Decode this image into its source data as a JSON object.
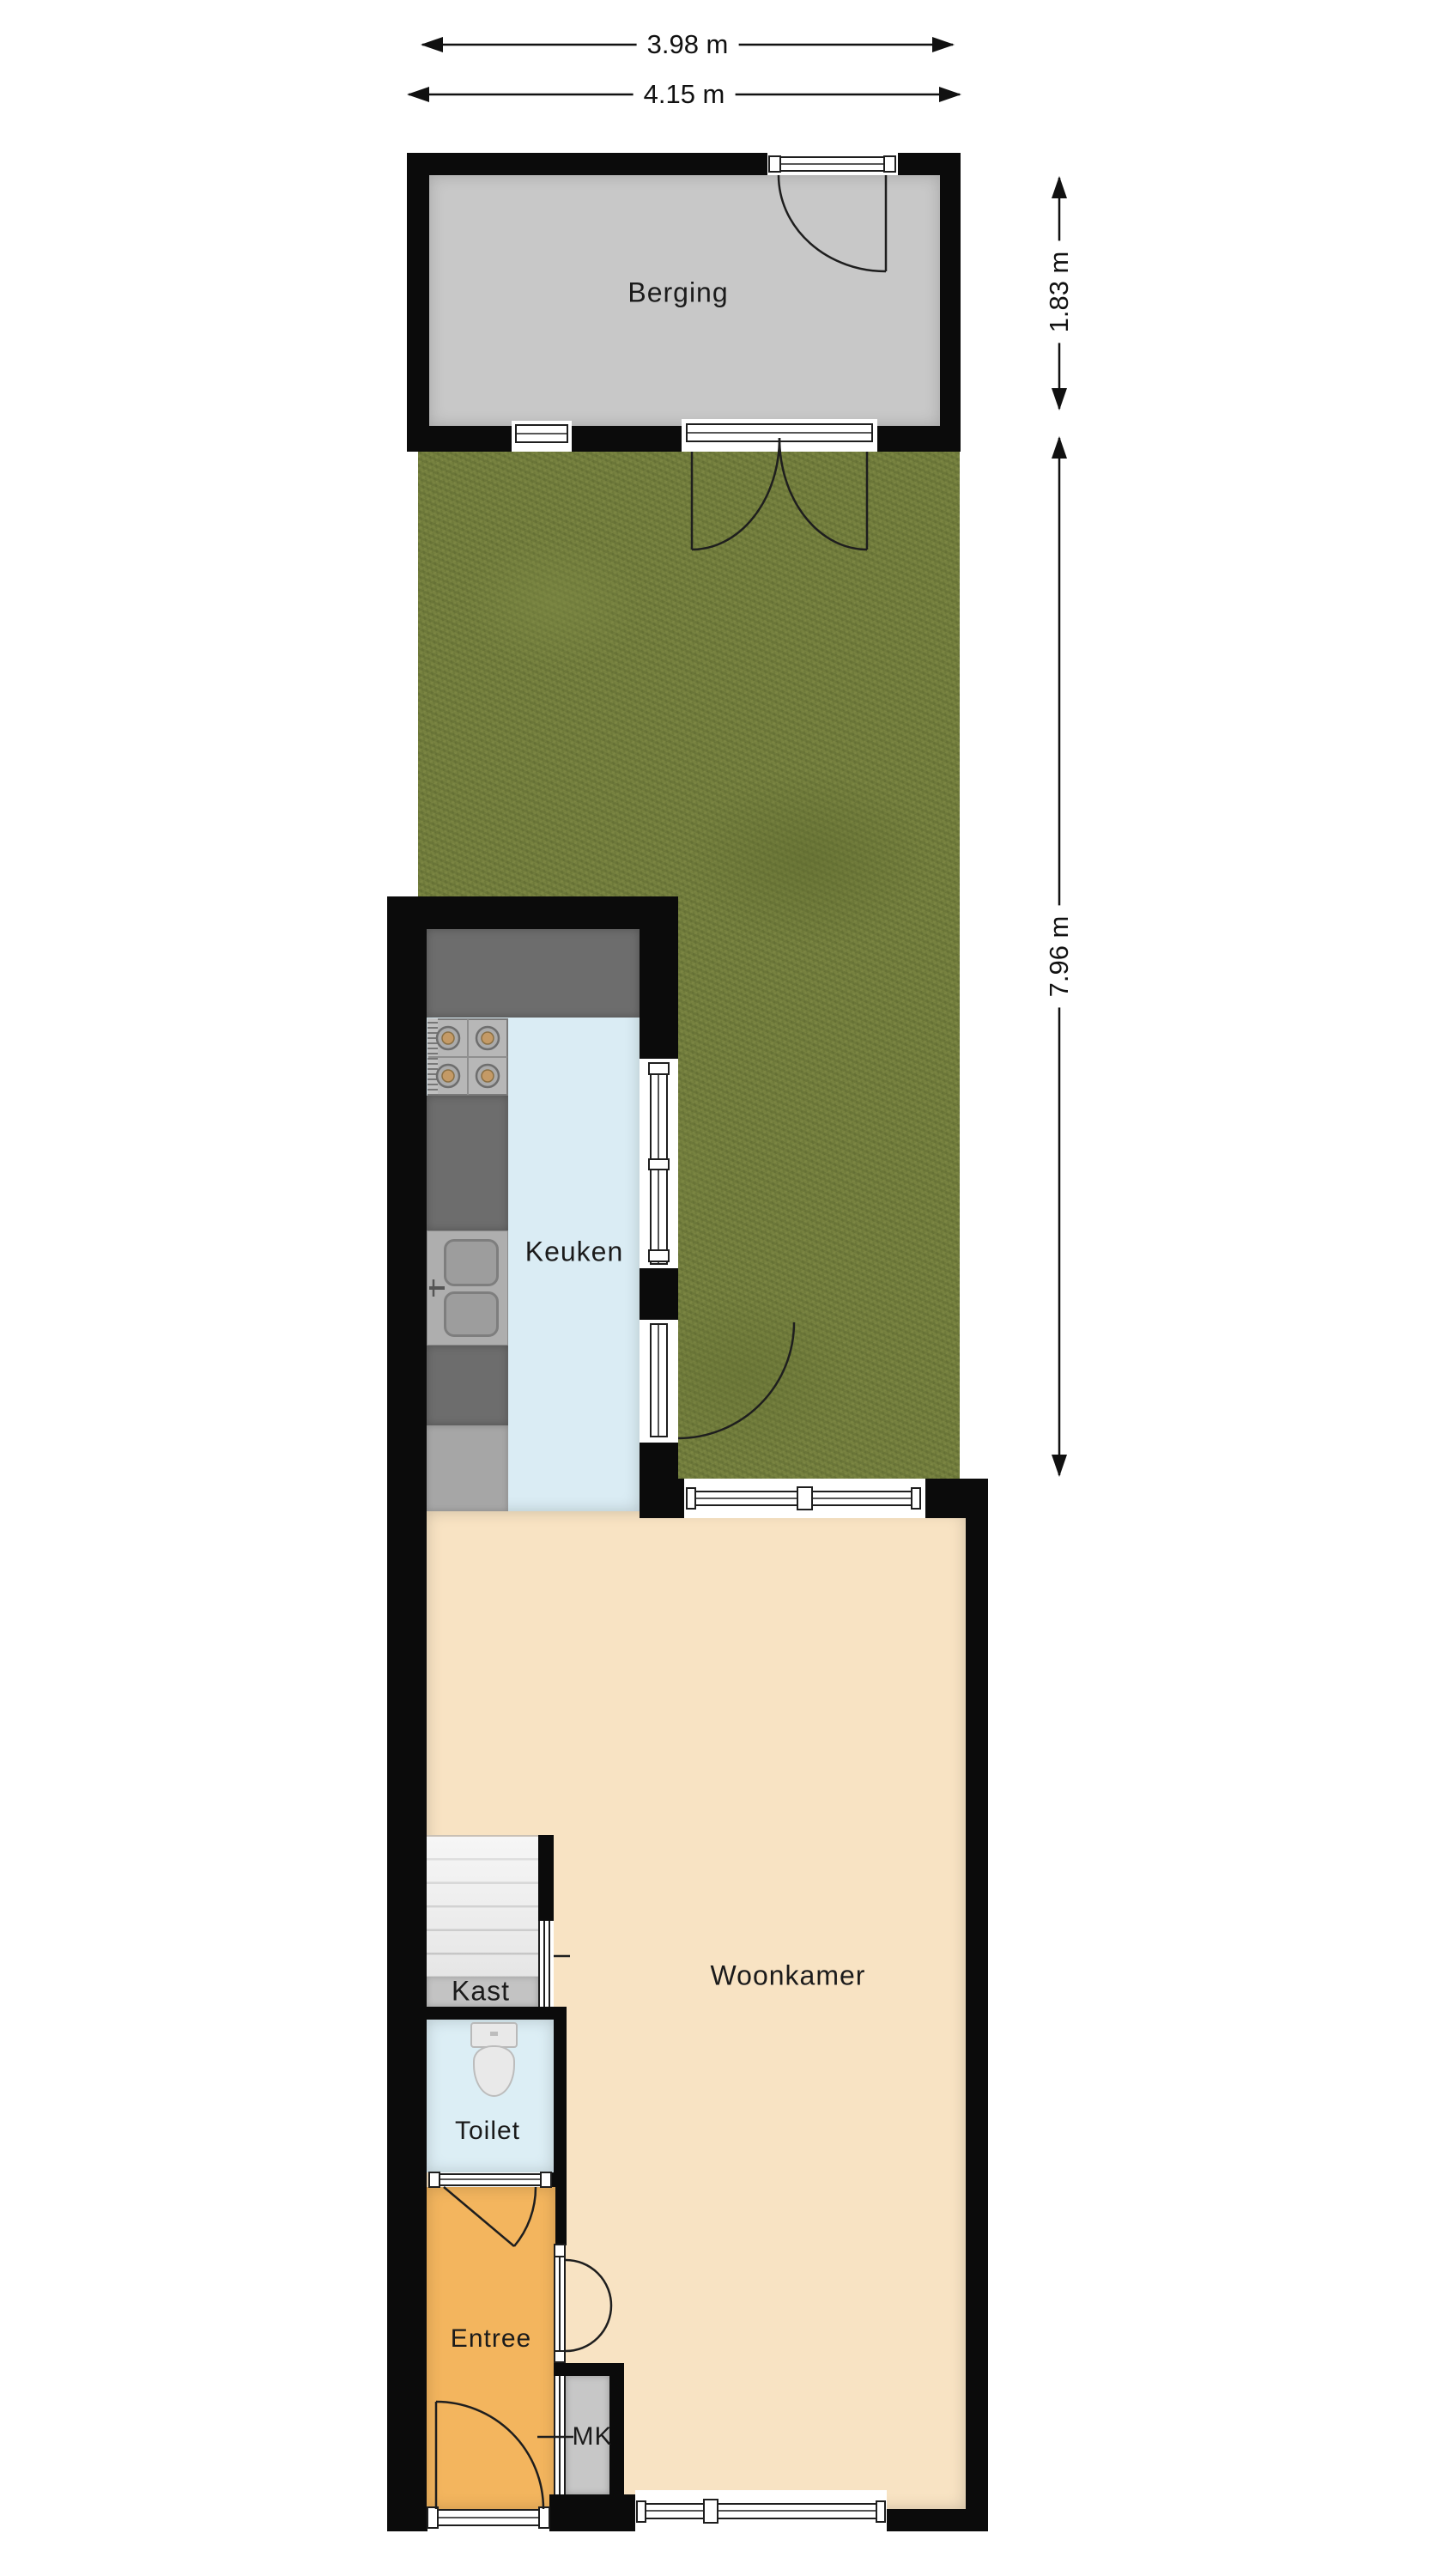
{
  "plan": {
    "rooms": {
      "berging": "Berging",
      "keuken": "Keuken",
      "woonkamer": "Woonkamer",
      "kast": "Kast",
      "toilet": "Toilet",
      "entree": "Entree",
      "mk": "MK"
    },
    "dimensions": {
      "width_inner": "3.98 m",
      "width_outer": "4.15 m",
      "shed_depth": "1.83 m",
      "garden_depth": "7.96 m"
    },
    "colors": {
      "wall": "#0b0b0b",
      "garden": "#76813f",
      "shed_floor": "#c8c8c8",
      "kitchen_floor": "#daecf4",
      "living_floor": "#f8e3c3",
      "entry_floor": "#f3b55e",
      "toilet_floor": "#dceef5",
      "mk_floor": "#c7c7c7",
      "closet_floor": "#c3c3c3"
    }
  }
}
